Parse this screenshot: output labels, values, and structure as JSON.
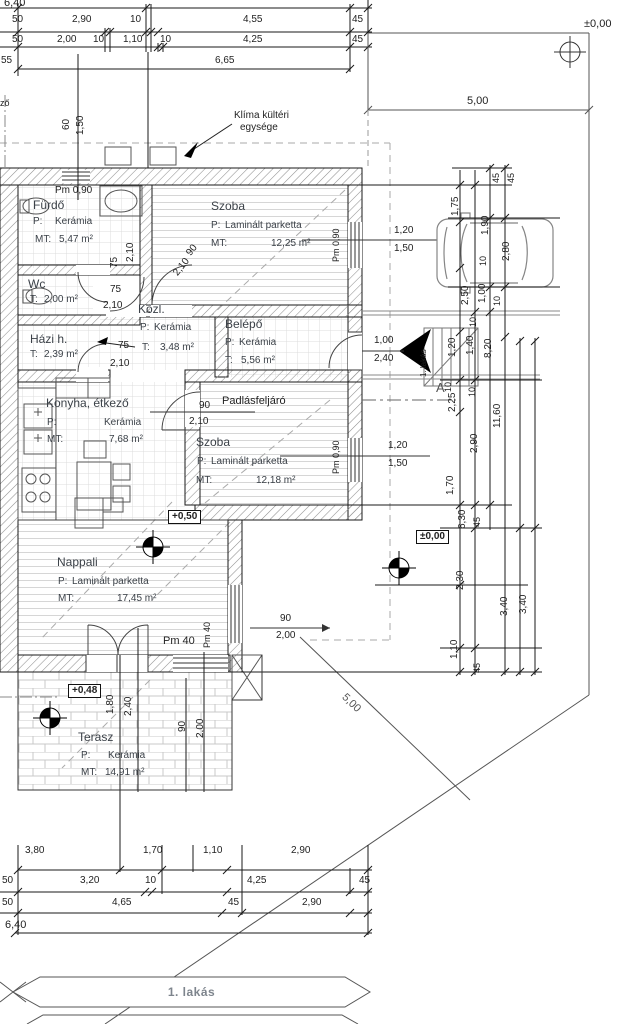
{
  "banner": {
    "label": "1. lakás"
  },
  "site": {
    "origin_top": "±0,00",
    "origin_mid": "±0,00",
    "width_top": "5,00",
    "boundary": "5,00"
  },
  "klima": {
    "l1": "Klíma kültéri",
    "l2": "egysége"
  },
  "notes": {
    "padlas": "Padlásfeljáró",
    "level_nappali": "+0,50",
    "level_terasz": "+0,48",
    "section": "A",
    "entry": "1. lakás",
    "frag": "ző"
  },
  "rooms": [
    {
      "name": "Fürdő",
      "fp": "P:",
      "fm": "Kerámia",
      "ap": "MT:",
      "av": "5,47 m²"
    },
    {
      "name": "Szoba",
      "fp": "P:",
      "fm": "Laminált parketta",
      "ap": "MT:",
      "av": "12,25 m²"
    },
    {
      "name": "Wc",
      "ap": "T:",
      "av": "2,00 m²"
    },
    {
      "name": "Közl.",
      "fp": "P:",
      "fm": "Kerámia",
      "ap": "T:",
      "av": "3,48 m²"
    },
    {
      "name": "Belépő",
      "fp": "P:",
      "fm": "Kerámia",
      "ap": "T:",
      "av": "5,56 m²"
    },
    {
      "name": "Házi h.",
      "ap": "T:",
      "av": "2,39 m²"
    },
    {
      "name": "Konyha, étkező",
      "fp": "P:",
      "fm": "Kerámia",
      "ap": "MT:",
      "av": "7,68 m²"
    },
    {
      "name": "Szoba",
      "fp": "P:",
      "fm": "Laminált parketta",
      "ap": "MT:",
      "av": "12,18 m²"
    },
    {
      "name": "Nappali",
      "fp": "P:",
      "fm": "Laminált parketta",
      "ap": "MT:",
      "av": "17,45 m²"
    },
    {
      "name": "Terasz",
      "fp": "P:",
      "fm": "Kerámia",
      "ap": "MT:",
      "av": "14,91 m²"
    }
  ],
  "top": {
    "r0": "6,40",
    "r1": [
      "50",
      "2,90",
      "10",
      "4,55",
      "45"
    ],
    "r2": [
      "50",
      "2,00",
      "10",
      "1,10",
      "10",
      "4,25",
      "45"
    ],
    "r3": [
      "55",
      "6,65"
    ],
    "v60": "60",
    "v150": "1,50"
  },
  "bottom": {
    "r1": [
      "3,80",
      "1,70",
      "1,10",
      "2,90"
    ],
    "r2": [
      "50",
      "3,20",
      "10",
      "4,25",
      "45"
    ],
    "r3": [
      "50",
      "4,65",
      "45",
      "2,90"
    ],
    "r4": "6,40"
  },
  "right": [
    "45",
    "45",
    "1,75",
    "1,90",
    "2,80",
    "10",
    "2,50",
    "1,00",
    "10",
    "10",
    "1,20",
    "1,40",
    "8,20",
    "10",
    "10",
    "2,25",
    "11,60",
    "2,90",
    "1,70",
    "6,30",
    "45",
    "2,30",
    "3,40",
    "3,40",
    "1,10",
    "45"
  ],
  "open": {
    "furdo_w": "75",
    "furdo_h": "2,10",
    "szoba1_w": "90",
    "szoba1_h": "2,10",
    "wc_w": "75",
    "wc_h": "2,10",
    "kozl_w": "75",
    "kozl_h": "2,10",
    "szoba2_w": "90",
    "szoba2_h": "2,10",
    "entry_w": "1,00",
    "entry_h": "2,40",
    "win1_w": "1,20",
    "win1_h": "1,50",
    "win2_w": "1,20",
    "win2_h": "1,50",
    "napw_w": "90",
    "napw_h": "2,00",
    "pm090a": "Pm 0,90",
    "pm090b": "Pm 0,90",
    "pm090c": "Pm 0,90",
    "pm40a": "Pm 40",
    "pm40b": "Pm 40",
    "t180": "1,80",
    "t240": "2,40",
    "t90": "90",
    "t200": "2,00"
  }
}
